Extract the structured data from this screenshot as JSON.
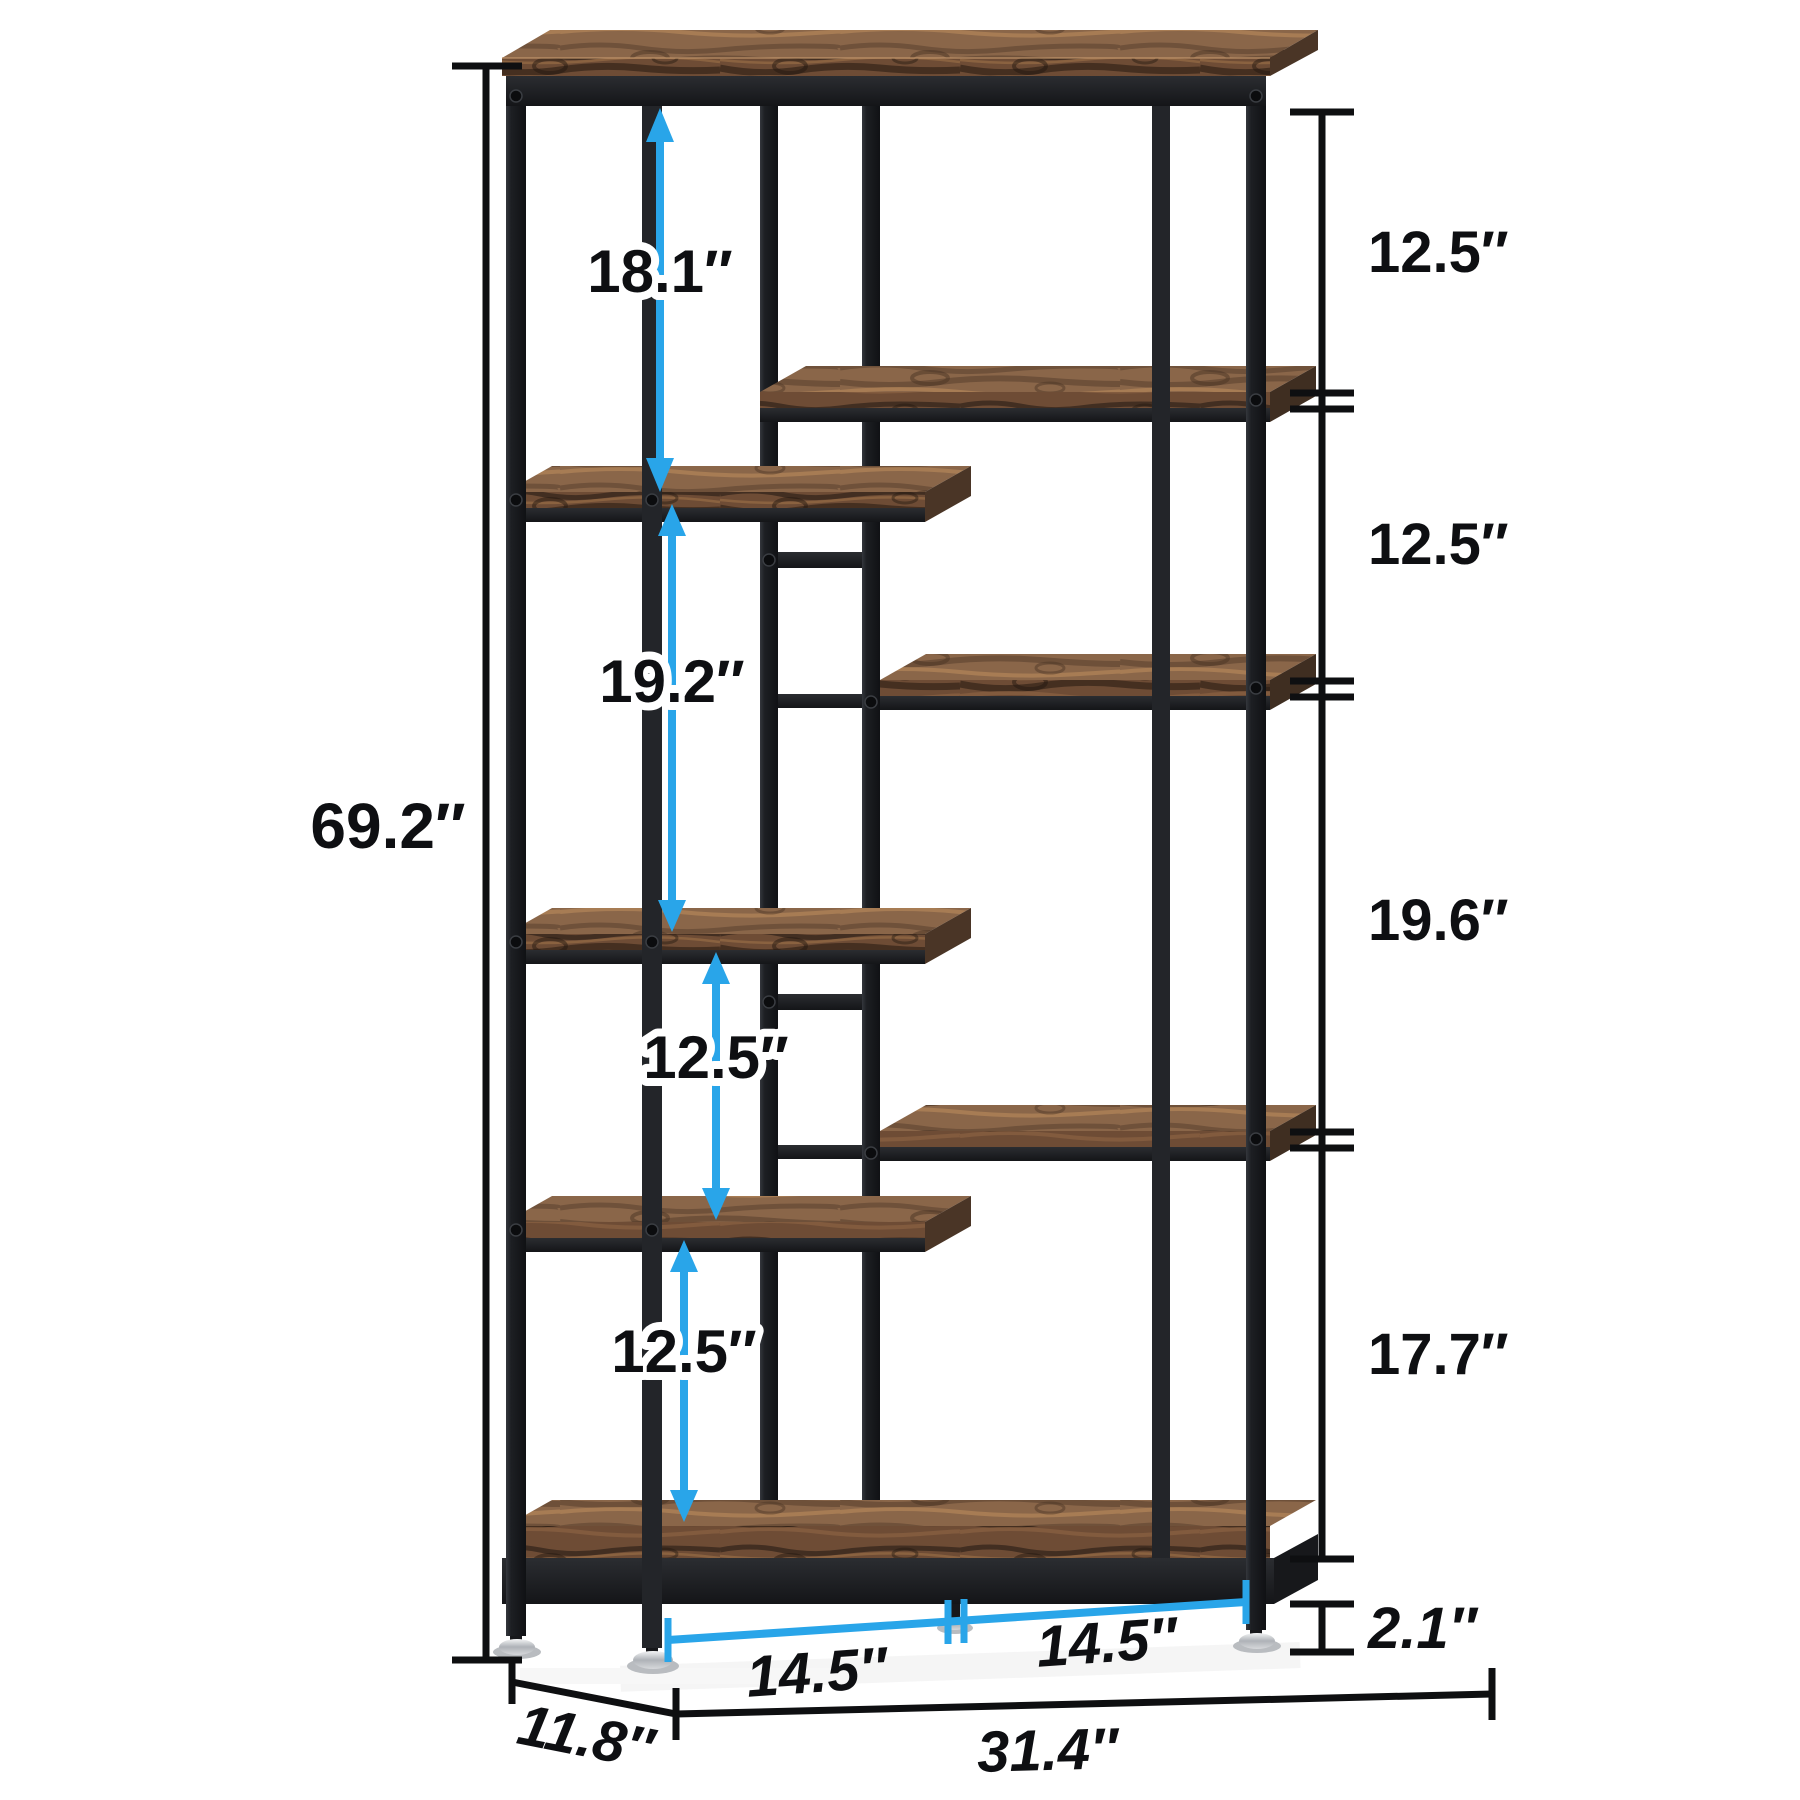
{
  "diagram": {
    "type": "product-dimension-diagram",
    "subject": "staggered 8-shelf etagere bookshelf",
    "colors": {
      "arrow_blue": "#29a5e9",
      "dimension_black": "#0e0f11",
      "frame_black": "#1d1f23",
      "wood_front": "#6e4c35",
      "wood_top": "#8a6649",
      "background": "#ffffff"
    }
  },
  "dims": {
    "overall_height": "69.2″",
    "upper_left_opening": "18.1″",
    "middle_left_opening": "19.2″",
    "lower_left_opening_1": "12.5″",
    "lower_left_opening_2": "12.5″",
    "right_opening_1": "12.5″",
    "right_opening_2": "12.5″",
    "right_opening_3": "19.6″",
    "right_opening_4": "17.7″",
    "base_clearance": "2.1″",
    "base_left_span": "14.5″",
    "base_right_span": "14.5″",
    "overall_width": "31.4″",
    "overall_depth": "11.8″"
  }
}
